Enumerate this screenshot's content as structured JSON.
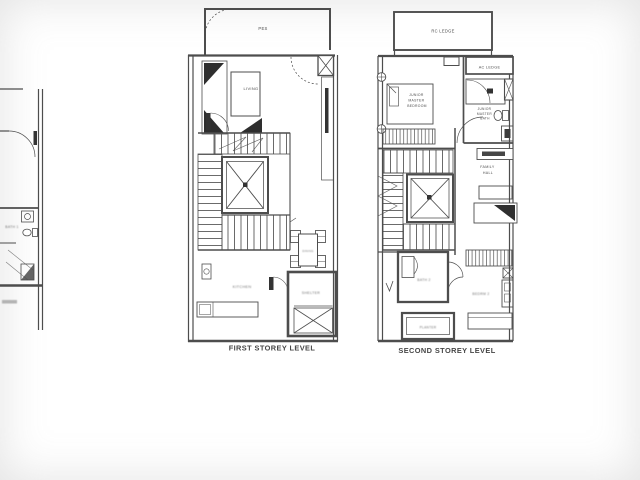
{
  "sheet": {
    "colors": {
      "background": "#ffffff",
      "ink": "#4d4d4d",
      "dark_fill": "#333333"
    }
  },
  "adjacent_unit": {
    "bath_label": "BATH 1"
  },
  "first_storey": {
    "caption": "FIRST STOREY LEVEL",
    "labels": {
      "pes": "PES",
      "living": "LIVING",
      "dining": "DINING",
      "kitchen": "KITCHEN",
      "shelter": "SHELTER"
    }
  },
  "second_storey": {
    "caption": "SECOND STOREY LEVEL",
    "labels": {
      "rc_ledge": "RC LEDGE",
      "ac_ledge": "AC LEDGE",
      "junior_master_bedroom": [
        "JUNIOR",
        "MASTER",
        "BEDROOM"
      ],
      "junior_master_bath": [
        "JUNIOR",
        "MASTER",
        "BATH"
      ],
      "family_hall": [
        "FAMILY",
        "HALL"
      ],
      "bath2": "BATH 2",
      "bedroom2": "BEDRM 2",
      "planter": "PLANTER"
    }
  }
}
